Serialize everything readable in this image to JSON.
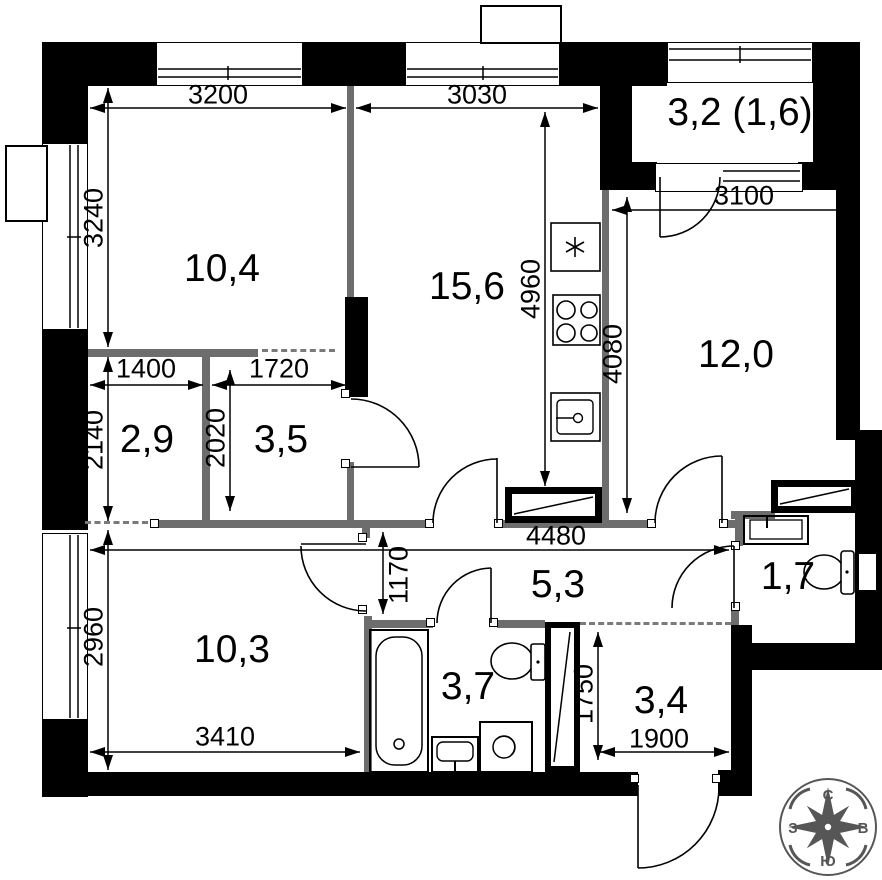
{
  "rooms": [
    {
      "id": "room-top-left",
      "label": "10,4"
    },
    {
      "id": "kitchen",
      "label": "15,6"
    },
    {
      "id": "balcony",
      "label": "3,2 (1,6)"
    },
    {
      "id": "room-right",
      "label": "12,0"
    },
    {
      "id": "wardrobe",
      "label": "2,9"
    },
    {
      "id": "hall-inner",
      "label": "3,5"
    },
    {
      "id": "corridor",
      "label": "5,3"
    },
    {
      "id": "wc",
      "label": "1,7"
    },
    {
      "id": "room-bottom-left",
      "label": "10,3"
    },
    {
      "id": "bathroom",
      "label": "3,7"
    },
    {
      "id": "hallway",
      "label": "3,4"
    }
  ],
  "dimensions_mm": [
    {
      "value": "3200"
    },
    {
      "value": "3030"
    },
    {
      "value": "3240"
    },
    {
      "value": "4960"
    },
    {
      "value": "3100"
    },
    {
      "value": "4080"
    },
    {
      "value": "1400"
    },
    {
      "value": "1720"
    },
    {
      "value": "2140"
    },
    {
      "value": "2020"
    },
    {
      "value": "4480"
    },
    {
      "value": "1170"
    },
    {
      "value": "2960"
    },
    {
      "value": "3410"
    },
    {
      "value": "1750"
    },
    {
      "value": "1900"
    }
  ],
  "compass": {
    "north": "С",
    "south": "Ю",
    "east": "В",
    "west": "З"
  }
}
